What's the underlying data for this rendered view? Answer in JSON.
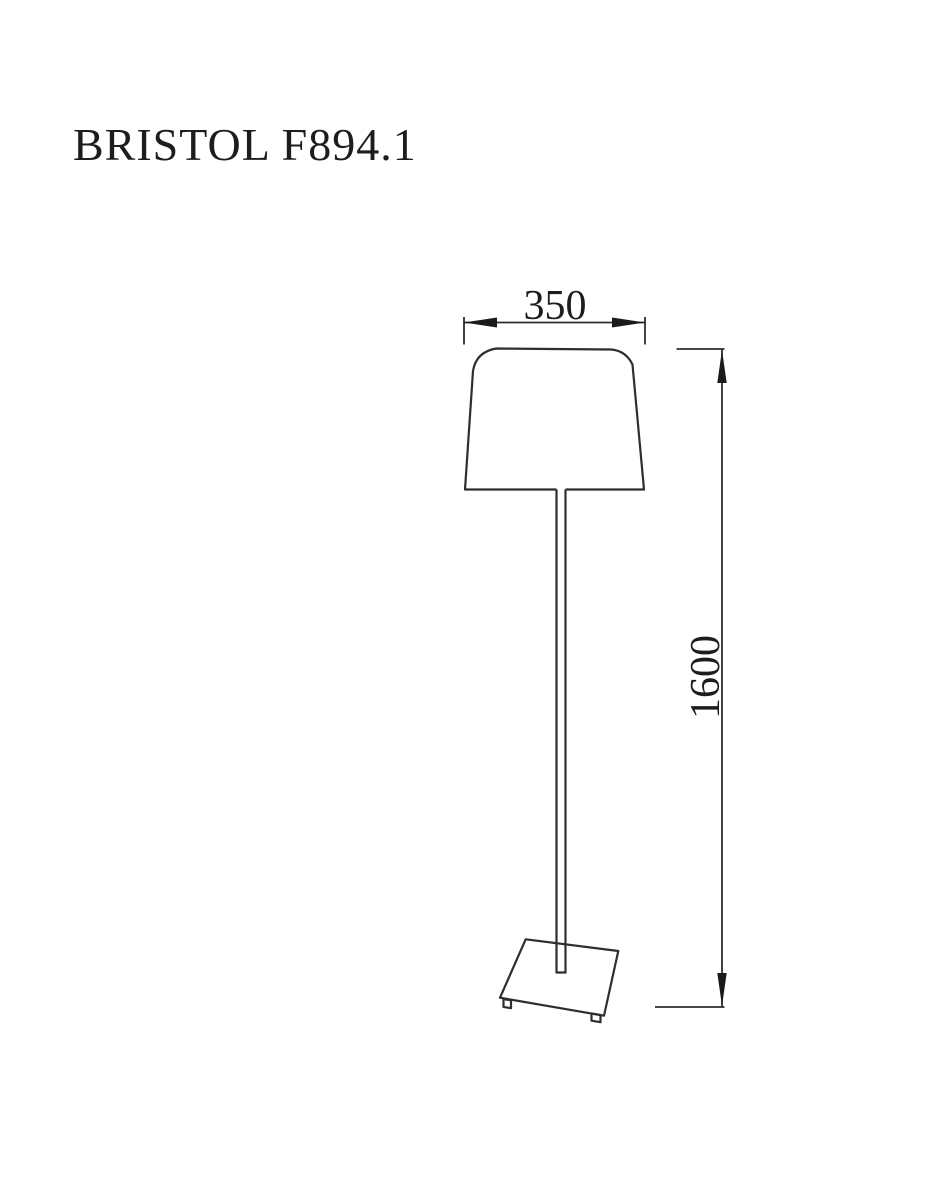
{
  "page": {
    "background": "#ffffff",
    "line_color": "#2e2e2e",
    "text_color": "#1d1d1d"
  },
  "title": "BRISTOL F894.1",
  "drawing": {
    "kind": "floor-lamp-dimension-drawing",
    "dimensions": {
      "width_label": "350",
      "height_label": "1600"
    }
  }
}
